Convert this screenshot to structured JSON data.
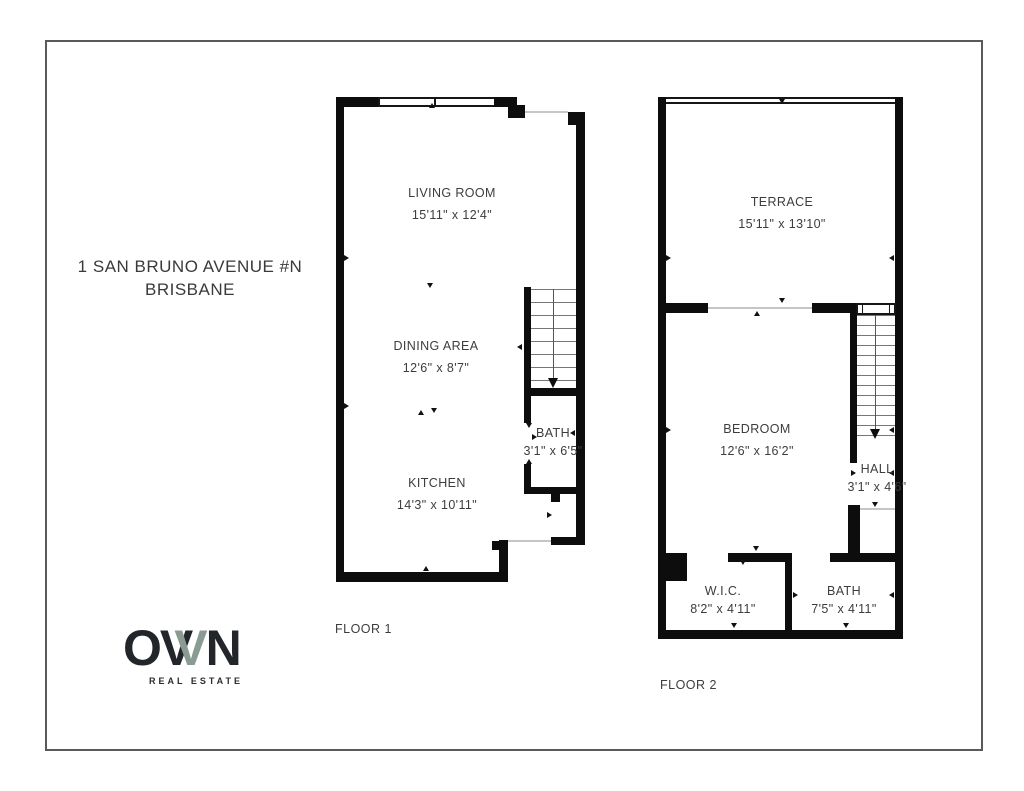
{
  "page": {
    "background": "#ffffff",
    "border_color": "#5a5a5a",
    "wall_color": "#0d0d0d"
  },
  "address": {
    "line1": "1 SAN BRUNO AVENUE #N",
    "line2": "BRISBANE"
  },
  "floor1": {
    "label": "FLOOR 1",
    "rooms": [
      {
        "name": "LIVING ROOM",
        "dims": "15'11\" x 12'4\""
      },
      {
        "name": "DINING AREA",
        "dims": "12'6\" x 8'7\""
      },
      {
        "name": "KITCHEN",
        "dims": "14'3\" x 10'11\""
      },
      {
        "name": "BATH",
        "dims": "3'1\" x 6'5\""
      }
    ]
  },
  "floor2": {
    "label": "FLOOR 2",
    "rooms": [
      {
        "name": "TERRACE",
        "dims": "15'11\" x 13'10\""
      },
      {
        "name": "BEDROOM",
        "dims": "12'6\" x 16'2\""
      },
      {
        "name": "HALL",
        "dims": "3'1\" x 4'6\""
      },
      {
        "name": "W.I.C.",
        "dims": "8'2\" x 4'11\""
      },
      {
        "name": "BATH",
        "dims": "7'5\" x 4'11\""
      }
    ]
  },
  "logo": {
    "letter_o": "O",
    "letter_v1": "V",
    "letter_v2": "V",
    "letter_n": "N",
    "tagline": "REAL ESTATE",
    "accent_color": "#8a9b93",
    "text_color": "#22262a"
  }
}
